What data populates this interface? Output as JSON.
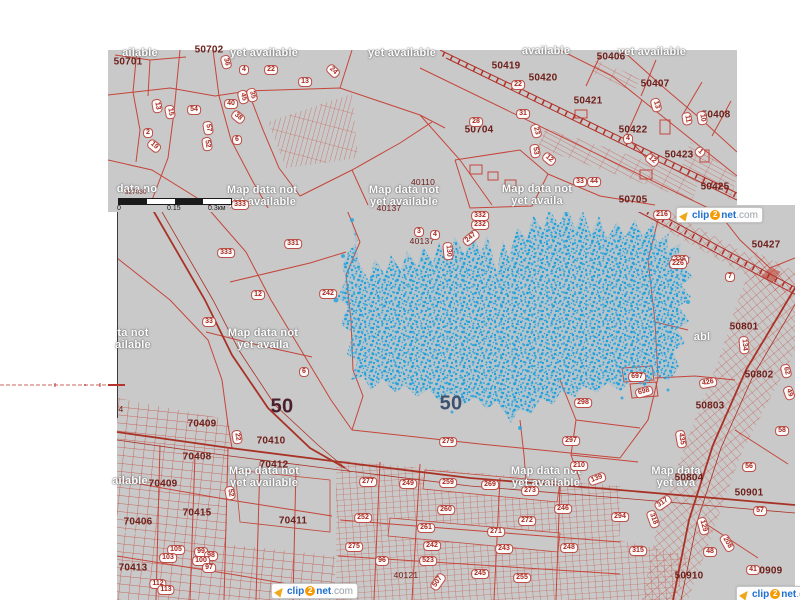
{
  "map": {
    "colors": {
      "map_gray": "#c9c9c9",
      "parcel_line": "#c5453a",
      "road_line": "#a93226",
      "selection_blue": "#2aa4dc",
      "zone_text": "#6e201b",
      "notice_text": "#ffffff"
    }
  },
  "scalebar": {
    "coord": "327030",
    "tick0": "0",
    "tick1": "0.15",
    "tick2": "0.3км"
  },
  "watermark": {
    "parts": {
      "icon": "clip2net-icon",
      "clip": "clip",
      "two": "2",
      "net": "net",
      "com": ".com"
    },
    "instances": [
      {
        "x": 676,
        "y": 207
      },
      {
        "x": 271,
        "y": 583
      },
      {
        "x": 736,
        "y": 586
      }
    ]
  },
  "labels": {
    "zone_numbers": [
      {
        "t": "50701",
        "x": 128,
        "y": 62
      },
      {
        "t": "50702",
        "x": 209,
        "y": 50
      },
      {
        "t": "50419",
        "x": 506,
        "y": 66
      },
      {
        "t": "50420",
        "x": 543,
        "y": 78
      },
      {
        "t": "50421",
        "x": 588,
        "y": 101
      },
      {
        "t": "50406",
        "x": 611,
        "y": 57
      },
      {
        "t": "50407",
        "x": 655,
        "y": 84
      },
      {
        "t": "50408",
        "x": 716,
        "y": 115
      },
      {
        "t": "50422",
        "x": 633,
        "y": 130
      },
      {
        "t": "50423",
        "x": 679,
        "y": 155
      },
      {
        "t": "50425",
        "x": 715,
        "y": 187
      },
      {
        "t": "50704",
        "x": 479,
        "y": 130
      },
      {
        "t": "50705",
        "x": 633,
        "y": 200
      },
      {
        "t": "40110",
        "x": 423,
        "y": 182,
        "cls": "sm"
      },
      {
        "t": "40137",
        "x": 389,
        "y": 208,
        "cls": "sm"
      },
      {
        "t": "40137",
        "x": 422,
        "y": 241,
        "cls": "sm"
      },
      {
        "t": "50427",
        "x": 766,
        "y": 245
      },
      {
        "t": "50801",
        "x": 744,
        "y": 327
      },
      {
        "t": "50802",
        "x": 759,
        "y": 375
      },
      {
        "t": "50803",
        "x": 710,
        "y": 406
      },
      {
        "t": "50804",
        "x": 689,
        "y": 478
      },
      {
        "t": "50901",
        "x": 749,
        "y": 493
      },
      {
        "t": "50909",
        "x": 768,
        "y": 571
      },
      {
        "t": "50910",
        "x": 689,
        "y": 576
      },
      {
        "t": "70408",
        "x": 197,
        "y": 457
      },
      {
        "t": "70409",
        "x": 202,
        "y": 424
      },
      {
        "t": "70410",
        "x": 271,
        "y": 441
      },
      {
        "t": "70412",
        "x": 274,
        "y": 465
      },
      {
        "t": "70409",
        "x": 163,
        "y": 484
      },
      {
        "t": "70415",
        "x": 197,
        "y": 513
      },
      {
        "t": "70406",
        "x": 138,
        "y": 522
      },
      {
        "t": "70411",
        "x": 293,
        "y": 521
      },
      {
        "t": "70413",
        "x": 133,
        "y": 568
      },
      {
        "t": "40121",
        "x": 406,
        "y": 575,
        "cls": "sm"
      },
      {
        "t": "4",
        "x": 121,
        "y": 409,
        "cls": "sm"
      },
      {
        "t": "50",
        "x": 282,
        "y": 407,
        "cls": "big1"
      },
      {
        "t": "50",
        "x": 451,
        "y": 404,
        "cls": "big2"
      }
    ],
    "parcel_pills": [
      {
        "t": "13",
        "x": 157,
        "y": 106,
        "r": 80
      },
      {
        "t": "15",
        "x": 170,
        "y": 112,
        "r": 80
      },
      {
        "t": "54",
        "x": 194,
        "y": 110
      },
      {
        "t": "57",
        "x": 208,
        "y": 128,
        "r": 80
      },
      {
        "t": "52",
        "x": 207,
        "y": 144,
        "r": 80
      },
      {
        "t": "2",
        "x": 148,
        "y": 133
      },
      {
        "t": "19",
        "x": 154,
        "y": 146,
        "r": 40
      },
      {
        "t": "40",
        "x": 231,
        "y": 104
      },
      {
        "t": "45",
        "x": 243,
        "y": 97,
        "r": 75
      },
      {
        "t": "35",
        "x": 252,
        "y": 95,
        "r": 75
      },
      {
        "t": "38",
        "x": 238,
        "y": 117,
        "r": 40
      },
      {
        "t": "6",
        "x": 237,
        "y": 140
      },
      {
        "t": "36",
        "x": 226,
        "y": 62,
        "r": 75
      },
      {
        "t": "4",
        "x": 244,
        "y": 70
      },
      {
        "t": "22",
        "x": 271,
        "y": 70
      },
      {
        "t": "13",
        "x": 305,
        "y": 82
      },
      {
        "t": "24",
        "x": 333,
        "y": 71,
        "r": 45
      },
      {
        "t": "28",
        "x": 476,
        "y": 122
      },
      {
        "t": "31",
        "x": 523,
        "y": 114
      },
      {
        "t": "22",
        "x": 518,
        "y": 85
      },
      {
        "t": "23",
        "x": 536,
        "y": 131,
        "r": 75
      },
      {
        "t": "53",
        "x": 535,
        "y": 151,
        "r": 80
      },
      {
        "t": "12",
        "x": 549,
        "y": 159,
        "r": 40
      },
      {
        "t": "10",
        "x": 702,
        "y": 118,
        "r": 80
      },
      {
        "t": "11",
        "x": 687,
        "y": 119,
        "r": 80
      },
      {
        "t": "4",
        "x": 628,
        "y": 139
      },
      {
        "t": "13",
        "x": 656,
        "y": 105,
        "r": 75
      },
      {
        "t": "12",
        "x": 652,
        "y": 160,
        "r": 40
      },
      {
        "t": "1",
        "x": 700,
        "y": 152,
        "r": 45
      },
      {
        "t": "33",
        "x": 580,
        "y": 182
      },
      {
        "t": "44",
        "x": 594,
        "y": 182
      },
      {
        "t": "333",
        "x": 240,
        "y": 205
      },
      {
        "t": "333",
        "x": 226,
        "y": 253
      },
      {
        "t": "331",
        "x": 293,
        "y": 244
      },
      {
        "t": "242",
        "x": 328,
        "y": 294
      },
      {
        "t": "12",
        "x": 258,
        "y": 295
      },
      {
        "t": "33",
        "x": 209,
        "y": 322
      },
      {
        "t": "6",
        "x": 304,
        "y": 372
      },
      {
        "t": "332",
        "x": 480,
        "y": 216
      },
      {
        "t": "232",
        "x": 480,
        "y": 225
      },
      {
        "t": "247",
        "x": 471,
        "y": 238,
        "r": -40
      },
      {
        "t": "130",
        "x": 448,
        "y": 251,
        "r": 85
      },
      {
        "t": "3",
        "x": 419,
        "y": 232
      },
      {
        "t": "4",
        "x": 435,
        "y": 235
      },
      {
        "t": "279",
        "x": 448,
        "y": 442
      },
      {
        "t": "298",
        "x": 583,
        "y": 403
      },
      {
        "t": "297",
        "x": 571,
        "y": 441
      },
      {
        "t": "210",
        "x": 579,
        "y": 466
      },
      {
        "t": "139",
        "x": 597,
        "y": 479,
        "r": -20
      },
      {
        "t": "697",
        "x": 637,
        "y": 377
      },
      {
        "t": "698",
        "x": 644,
        "y": 392,
        "r": -15
      },
      {
        "t": "426",
        "x": 708,
        "y": 383,
        "r": -10
      },
      {
        "t": "56",
        "x": 749,
        "y": 467
      },
      {
        "t": "57",
        "x": 760,
        "y": 511
      },
      {
        "t": "58",
        "x": 782,
        "y": 431
      },
      {
        "t": "317",
        "x": 663,
        "y": 503,
        "r": -35
      },
      {
        "t": "294",
        "x": 620,
        "y": 517
      },
      {
        "t": "318",
        "x": 653,
        "y": 519,
        "r": 70
      },
      {
        "t": "315",
        "x": 638,
        "y": 551
      },
      {
        "t": "277",
        "x": 368,
        "y": 482
      },
      {
        "t": "249",
        "x": 408,
        "y": 484
      },
      {
        "t": "259",
        "x": 448,
        "y": 483
      },
      {
        "t": "269",
        "x": 490,
        "y": 485
      },
      {
        "t": "273",
        "x": 530,
        "y": 491
      },
      {
        "t": "252",
        "x": 363,
        "y": 518
      },
      {
        "t": "260",
        "x": 446,
        "y": 510
      },
      {
        "t": "261",
        "x": 426,
        "y": 528
      },
      {
        "t": "272",
        "x": 527,
        "y": 521
      },
      {
        "t": "271",
        "x": 496,
        "y": 532
      },
      {
        "t": "246",
        "x": 563,
        "y": 509
      },
      {
        "t": "275",
        "x": 354,
        "y": 547
      },
      {
        "t": "242",
        "x": 432,
        "y": 546
      },
      {
        "t": "243",
        "x": 504,
        "y": 549
      },
      {
        "t": "248",
        "x": 569,
        "y": 548
      },
      {
        "t": "96",
        "x": 382,
        "y": 561
      },
      {
        "t": "523",
        "x": 428,
        "y": 561
      },
      {
        "t": "245",
        "x": 480,
        "y": 574
      },
      {
        "t": "255",
        "x": 522,
        "y": 578
      },
      {
        "t": "507",
        "x": 438,
        "y": 582,
        "r": -55
      },
      {
        "t": "7",
        "x": 730,
        "y": 277
      },
      {
        "t": "226",
        "x": 680,
        "y": 260
      },
      {
        "t": "216",
        "x": 662,
        "y": 215
      },
      {
        "t": "226",
        "x": 678,
        "y": 264
      },
      {
        "t": "134",
        "x": 744,
        "y": 345,
        "r": 85
      },
      {
        "t": "62",
        "x": 786,
        "y": 371,
        "r": 75
      },
      {
        "t": "435",
        "x": 681,
        "y": 439,
        "r": 80
      },
      {
        "t": "129",
        "x": 703,
        "y": 526,
        "r": 75
      },
      {
        "t": "208",
        "x": 727,
        "y": 543,
        "r": 60
      },
      {
        "t": "48",
        "x": 710,
        "y": 552
      },
      {
        "t": "41",
        "x": 753,
        "y": 570
      },
      {
        "t": "49",
        "x": 789,
        "y": 393,
        "r": 70
      },
      {
        "t": "105",
        "x": 176,
        "y": 550
      },
      {
        "t": "99",
        "x": 201,
        "y": 552
      },
      {
        "t": "98",
        "x": 211,
        "y": 556
      },
      {
        "t": "100",
        "x": 201,
        "y": 561
      },
      {
        "t": "97",
        "x": 209,
        "y": 568
      },
      {
        "t": "103",
        "x": 168,
        "y": 558
      },
      {
        "t": "112",
        "x": 158,
        "y": 584
      },
      {
        "t": "113",
        "x": 166,
        "y": 590
      },
      {
        "t": "52",
        "x": 230,
        "y": 493,
        "r": 80
      },
      {
        "t": "22",
        "x": 237,
        "y": 437,
        "r": 80
      }
    ],
    "map_data_notices": [
      {
        "t": "ailable",
        "x": 140,
        "y": 53
      },
      {
        "t": "yet available",
        "x": 264,
        "y": 53
      },
      {
        "t": "yet available",
        "x": 402,
        "y": 53
      },
      {
        "t": "available",
        "x": 546,
        "y": 51
      },
      {
        "t": "yet available",
        "x": 652,
        "y": 52
      },
      {
        "t": "data no",
        "x": 137,
        "y": 189
      },
      {
        "t": "Map data not\nyet available",
        "x": 262,
        "y": 196
      },
      {
        "t": "Map data not\nyet available",
        "x": 404,
        "y": 196
      },
      {
        "t": "Map data not\nyet availa",
        "x": 537,
        "y": 195
      },
      {
        "t": "ta not\nailable",
        "x": 133,
        "y": 339
      },
      {
        "t": "Map data not\nyet availa",
        "x": 263,
        "y": 339
      },
      {
        "t": "abl",
        "x": 702,
        "y": 337
      },
      {
        "t": "Map data not\nyet available",
        "x": 264,
        "y": 477
      },
      {
        "t": "Map data not\nyet available",
        "x": 546,
        "y": 477
      },
      {
        "t": "Map data\nyet ava",
        "x": 676,
        "y": 477
      },
      {
        "t": "ailable",
        "x": 130,
        "y": 481
      }
    ]
  }
}
